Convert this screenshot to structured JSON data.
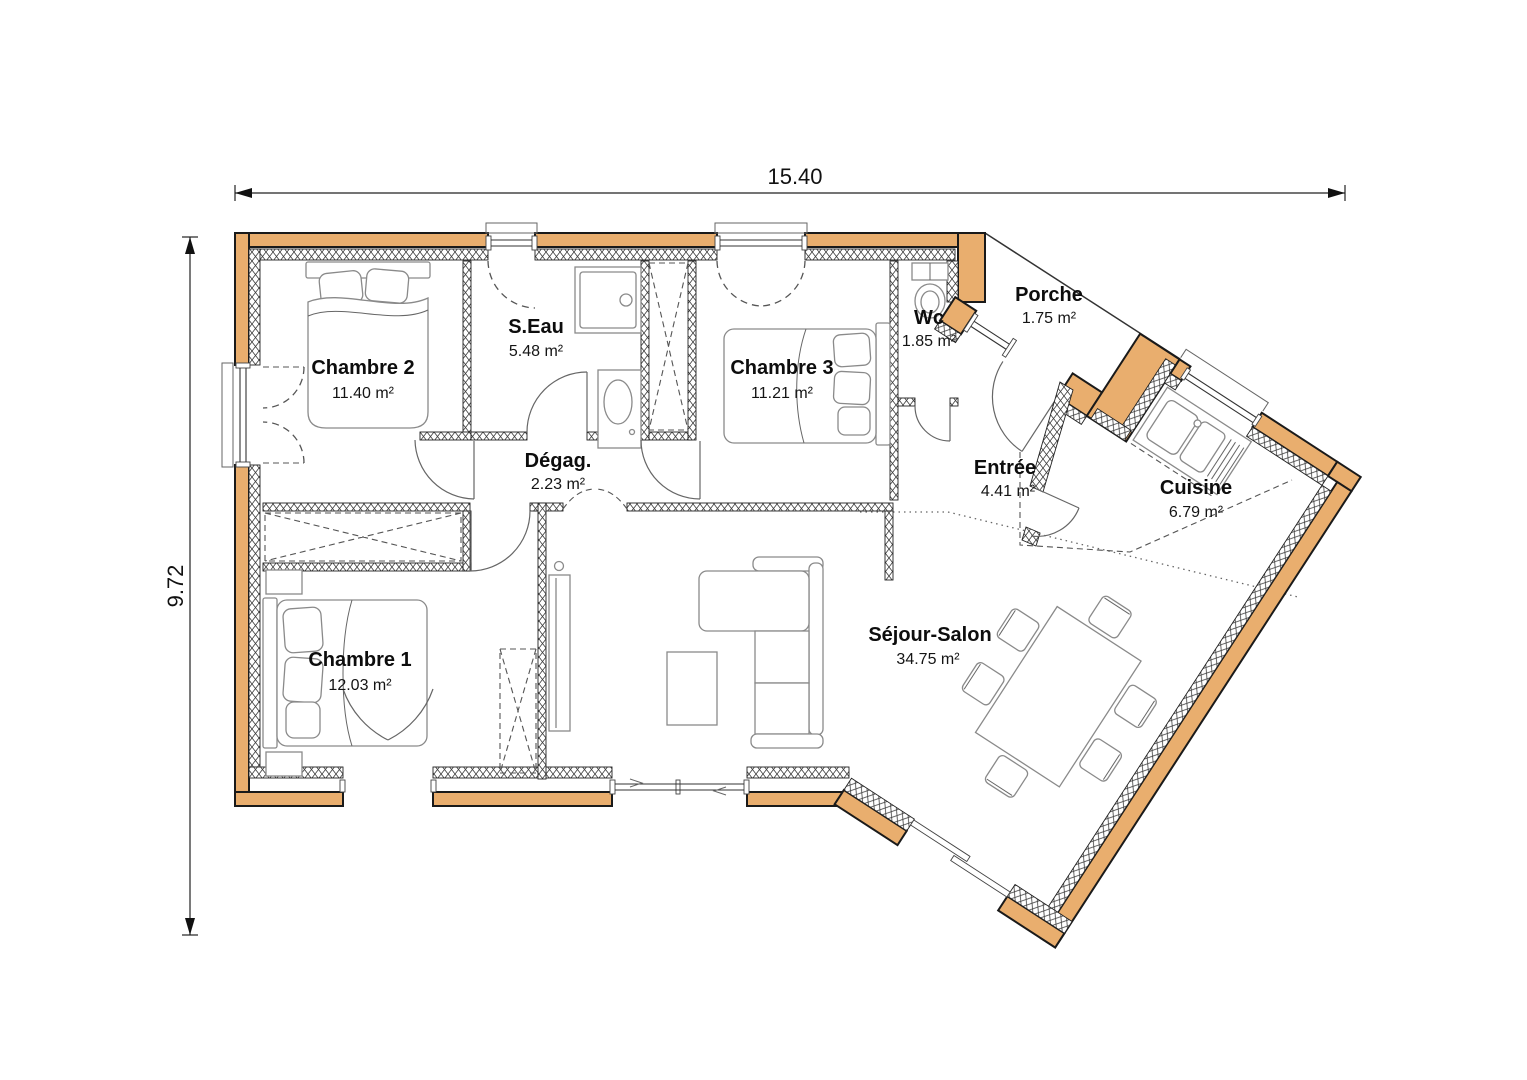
{
  "plan": {
    "dimension_width": "15.40",
    "dimension_height": "9.72",
    "rooms": [
      {
        "name": "Chambre 2",
        "area": "11.40 m²"
      },
      {
        "name": "S.Eau",
        "area": "5.48 m²"
      },
      {
        "name": "Chambre 3",
        "area": "11.21 m²"
      },
      {
        "name": "Wc",
        "area": "1.85 m²"
      },
      {
        "name": "Porche",
        "area": "1.75 m²"
      },
      {
        "name": "Dégag.",
        "area": "2.23 m²"
      },
      {
        "name": "Entrée",
        "area": "4.41 m²"
      },
      {
        "name": "Cuisine",
        "area": "6.79 m²"
      },
      {
        "name": "Chambre 1",
        "area": "12.03 m²"
      },
      {
        "name": "Séjour-Salon",
        "area": "34.75 m²"
      }
    ],
    "colors": {
      "wall": "#e9ae6e",
      "outline": "#1a1a1a"
    }
  }
}
